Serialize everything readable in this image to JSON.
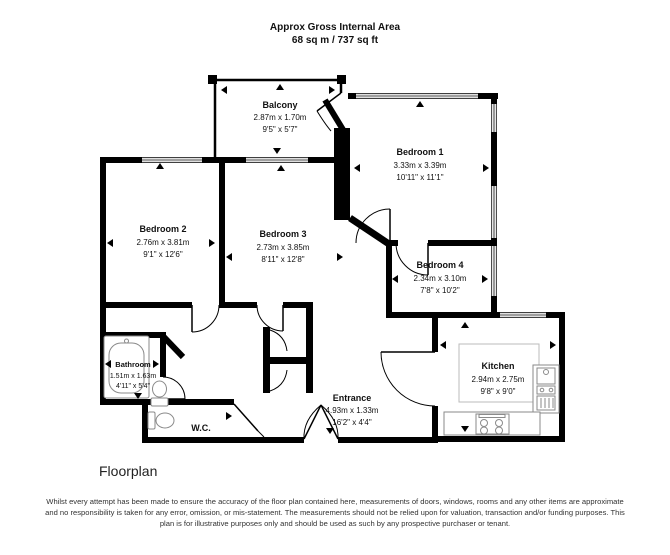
{
  "header": {
    "title": "Approx Gross Internal Area",
    "area": "68 sq m / 737 sq ft"
  },
  "rooms": {
    "balcony": {
      "name": "Balcony",
      "metric": "2.87m x 1.70m",
      "imperial": "9'5\" x 5'7\""
    },
    "bedroom1": {
      "name": "Bedroom 1",
      "metric": "3.33m x 3.39m",
      "imperial": "10'11\" x 11'1\""
    },
    "bedroom2": {
      "name": "Bedroom 2",
      "metric": "2.76m x 3.81m",
      "imperial": "9'1\" x 12'6\""
    },
    "bedroom3": {
      "name": "Bedroom 3",
      "metric": "2.73m x 3.85m",
      "imperial": "8'11\" x 12'8\""
    },
    "bedroom4": {
      "name": "Bedroom 4",
      "metric": "2.34m x 3.10m",
      "imperial": "7'8\" x 10'2\""
    },
    "kitchen": {
      "name": "Kitchen",
      "metric": "2.94m x 2.75m",
      "imperial": "9'8\" x 9'0\""
    },
    "bathroom": {
      "name": "Bathroom",
      "metric": "1.51m x 1.63m",
      "imperial": "4'11\" x 5'4\""
    },
    "entrance": {
      "name": "Entrance",
      "metric": "4.93m x 1.33m",
      "imperial": "16'2\" x 4'4\""
    },
    "wc": {
      "name": "W.C."
    }
  },
  "footer": {
    "caption": "Floorplan",
    "disclaimer": "Whilst every attempt has been made to ensure the accuracy of the floor plan contained here, measurements of doors, windows, rooms and any other items are approximate and no responsibility is taken for any error, omission, or mis-statement. The measurements should not be relied upon for valuation, transaction and/or funding purposes. This plan is for illustrative purposes only and should be used as such by any prospective purchaser or tenant."
  },
  "colors": {
    "wall": "#000000",
    "fixture": "#8a8a8a",
    "text": "#111111"
  }
}
